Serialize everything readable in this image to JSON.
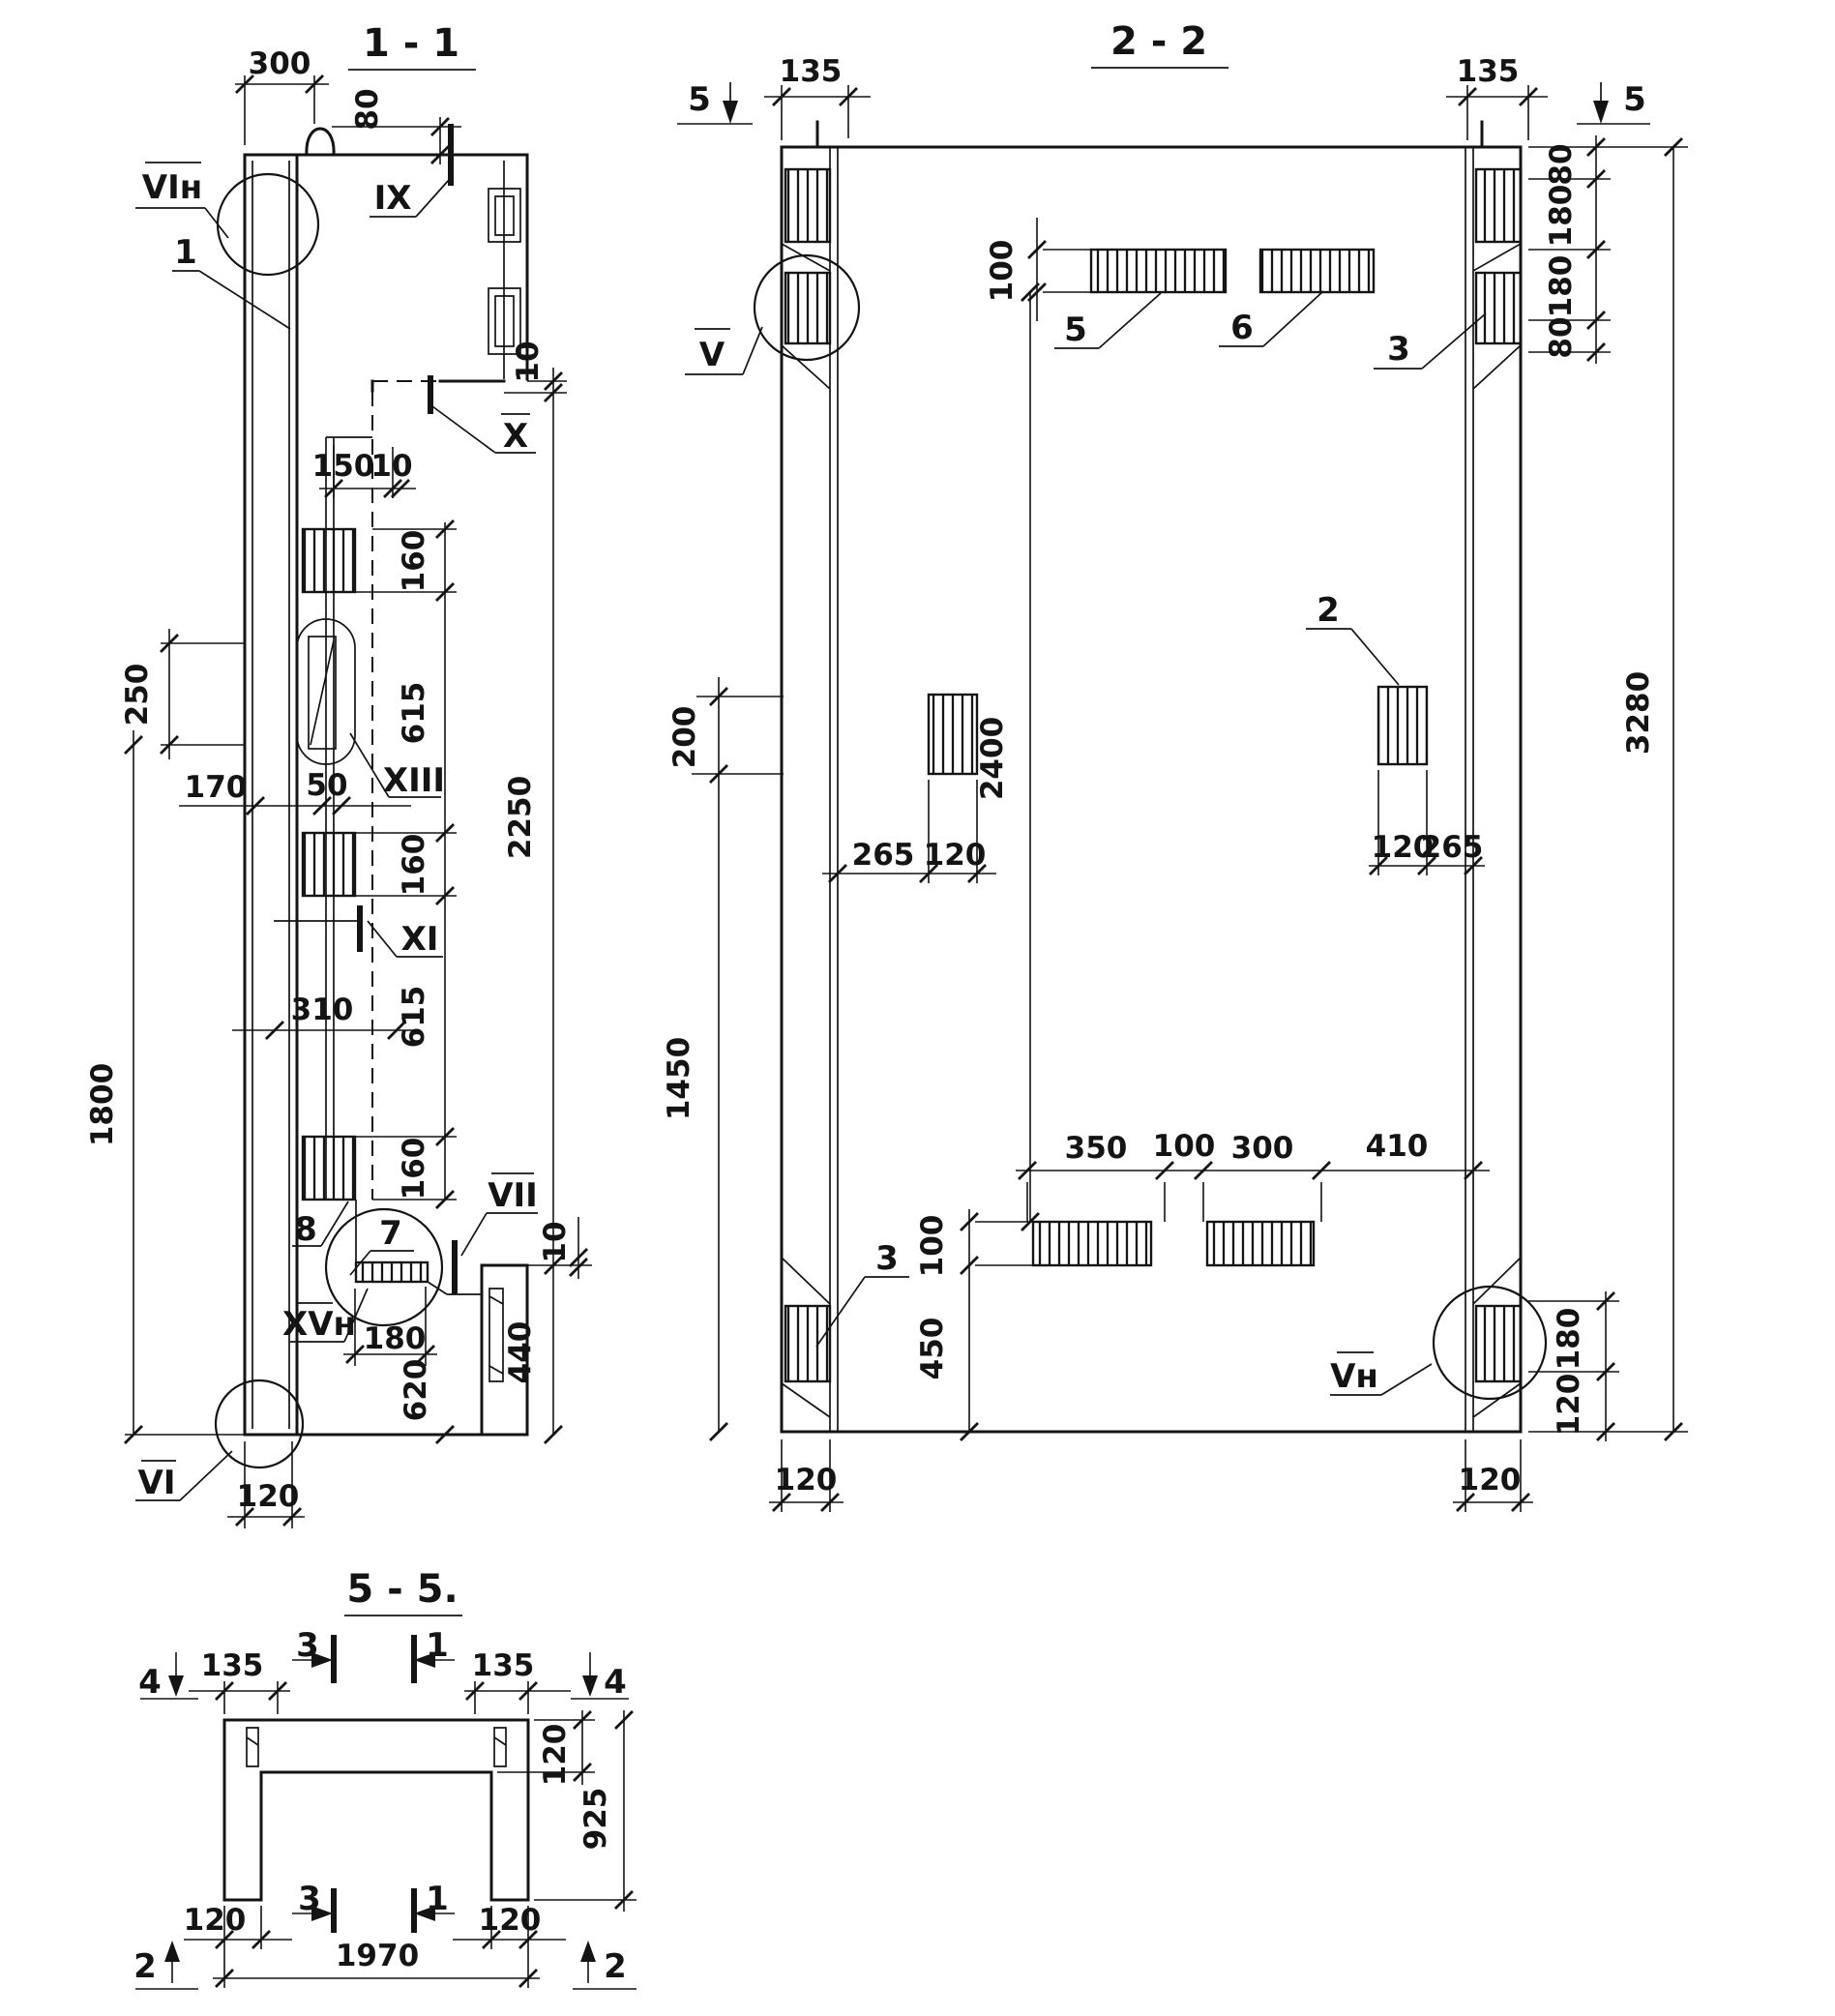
{
  "drawing": {
    "type": "structural-concrete-panel-sections",
    "ink_color": "#141414",
    "background_color": "#ffffff",
    "s11": {
      "title": "1 - 1",
      "labels": {
        "vin": "VIн",
        "n1": "1",
        "ix": "IX",
        "x": "X",
        "xiii": "XIII",
        "xi": "XI",
        "n8": "8",
        "n7": "7",
        "xvn": "XVн",
        "vii": "VII",
        "vi": "VI"
      },
      "dims": {
        "d300": "300",
        "d80": "80",
        "d10a": "10",
        "d150": "150",
        "d10b": "10",
        "d160a": "160",
        "d615a": "615",
        "d160b": "160",
        "d615b": "615",
        "d160c": "160",
        "d2250": "2250",
        "d250": "250",
        "d170": "170",
        "d50": "50",
        "d310": "310",
        "d1800": "1800",
        "d10c": "10",
        "d440": "440",
        "d620": "620",
        "d180": "180",
        "d120": "120"
      }
    },
    "s22": {
      "title": "2 - 2",
      "labels": {
        "m5l": "5",
        "m5r": "5",
        "v": "V",
        "vn": "Vн",
        "n2": "2",
        "n3r": "3",
        "n3l": "3",
        "n5": "5",
        "n6": "6"
      },
      "dims": {
        "d135l": "135",
        "d135r": "135",
        "d80a": "80",
        "d180a": "180",
        "d180b": "180",
        "d80b": "80",
        "d3280": "3280",
        "d100t": "100",
        "d200": "200",
        "d1450": "1450",
        "d265l": "265",
        "d120l": "120",
        "d120r": "120",
        "d265r": "265",
        "d2400": "2400",
        "d350": "350",
        "d100m": "100",
        "d300": "300",
        "d410": "410",
        "d100b": "100",
        "d450": "450",
        "d180r": "180",
        "d120rc": "120",
        "d120bl": "120",
        "d120br": "120"
      }
    },
    "s55": {
      "title": "5 - 5.",
      "labels": {
        "m4l": "4",
        "m4r": "4",
        "m3t": "3",
        "m1t": "1",
        "m3b": "3",
        "m1b": "1",
        "m2l": "2",
        "m2r": "2"
      },
      "dims": {
        "d135l": "135",
        "d135r": "135",
        "d120t": "120",
        "d925": "925",
        "d120bl": "120",
        "d120br": "120",
        "d1970": "1970"
      }
    }
  }
}
